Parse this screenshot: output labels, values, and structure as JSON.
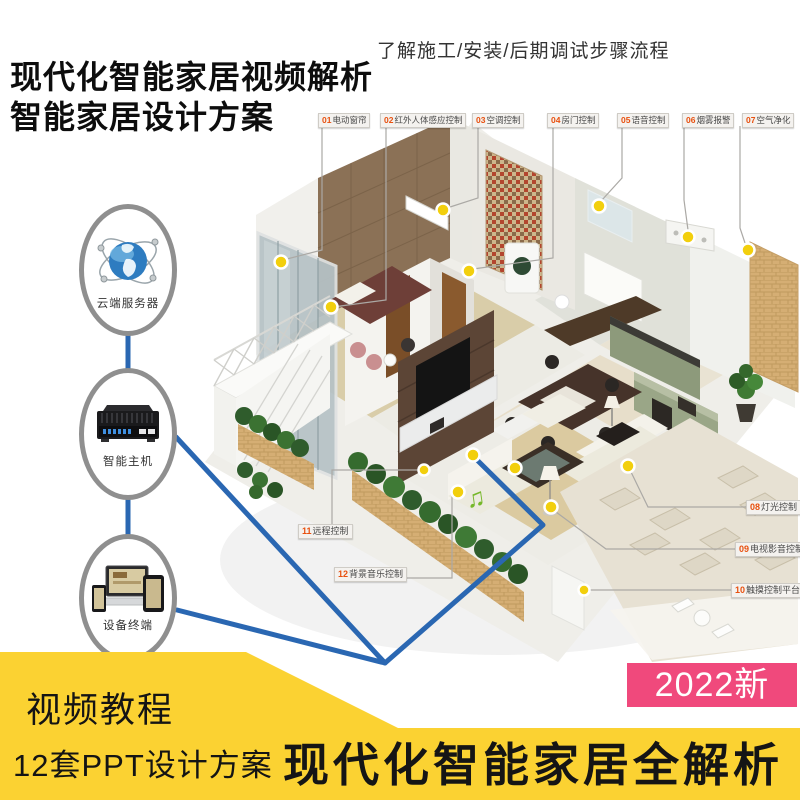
{
  "header": {
    "title_line1": "现代化智能家居视频解析",
    "title_line2": "智能家居设计方案",
    "subtitle": "了解施工/安装/后期调试步骤流程"
  },
  "feature_labels": [
    {
      "num": "01",
      "text": "电动窗帘"
    },
    {
      "num": "02",
      "text": "红外人体感应控制"
    },
    {
      "num": "03",
      "text": "空调控制"
    },
    {
      "num": "04",
      "text": "房门控制"
    },
    {
      "num": "05",
      "text": "语音控制"
    },
    {
      "num": "06",
      "text": "烟雾报警"
    },
    {
      "num": "07",
      "text": "空气净化"
    },
    {
      "num": "08",
      "text": "灯光控制"
    },
    {
      "num": "09",
      "text": "电视影音控制"
    },
    {
      "num": "10",
      "text": "触摸控制平台"
    },
    {
      "num": "11",
      "text": "远程控制"
    },
    {
      "num": "12",
      "text": "背景音乐控制"
    }
  ],
  "nodes": [
    {
      "label": "云端服务器",
      "icon": "globe-network-icon"
    },
    {
      "label": "智能主机",
      "icon": "smart-host-icon"
    },
    {
      "label": "设备终端",
      "icon": "devices-icon"
    }
  ],
  "footer": {
    "tagline1": "视频教程",
    "tagline2": "12套PPT设计方案",
    "banner": "现代化智能家居全解析",
    "badge": "2022新"
  },
  "colors": {
    "yellow": "#FBD232",
    "pink": "#F0497C",
    "blue": "#2A67B2",
    "orange": "#E8500F",
    "sensor_dot": "#F2CF0D"
  }
}
